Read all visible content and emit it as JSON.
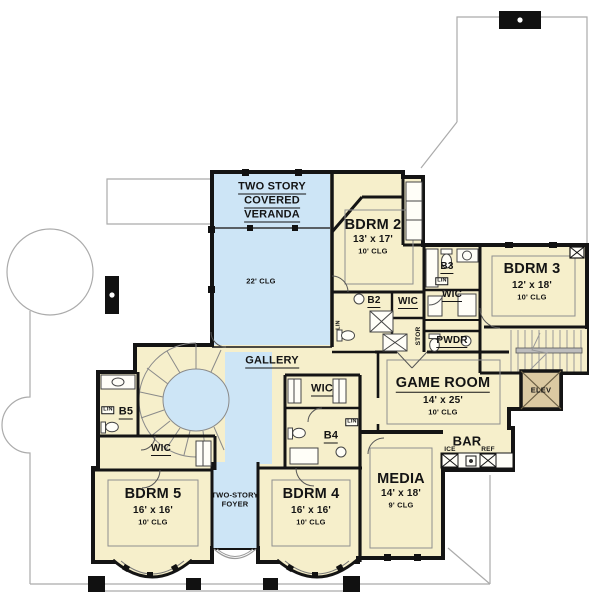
{
  "colors": {
    "room_fill": "#F6EFCB",
    "open_to_below_fill": "#CDE5F6",
    "elevator_fill": "#DBC9A2",
    "wall": "#141414",
    "roof_outline": "#ABABAB"
  },
  "icons": {
    "chimney_icon": "black box with white vent dot",
    "elevator_icon": "tan box with X cross",
    "stairs_icon": "parallel treads with rail",
    "spiral_stairs_icon": "radial fan treads around oval well",
    "door_icon": "quarter-circle swing arc",
    "window_icon": "black sill posts on wall",
    "shower_icon": "box with X",
    "toilet_icon": "ellipse bowl with tank",
    "sink_icon": "round basin"
  },
  "rooms": {
    "veranda": {
      "line1": "TWO STORY",
      "line2": "COVERED",
      "line3": "VERANDA",
      "clg": "22' CLG"
    },
    "bdrm2": {
      "name": "BDRM 2",
      "size": "13' x 17'",
      "clg": "10' CLG"
    },
    "bdrm3": {
      "name": "BDRM 3",
      "size": "12' x 18'",
      "clg": "10' CLG"
    },
    "game_room": {
      "name": "GAME ROOM",
      "size": "14' x 25'",
      "clg": "10' CLG"
    },
    "media": {
      "name": "MEDIA",
      "size": "14' x 18'",
      "clg": "9' CLG"
    },
    "bdrm4": {
      "name": "BDRM 4",
      "size": "16' x 16'",
      "clg": "10' CLG"
    },
    "bdrm5": {
      "name": "BDRM 5",
      "size": "16' x 16'",
      "clg": "10' CLG"
    },
    "foyer": {
      "line1": "TWO-STORY",
      "line2": "FOYER"
    },
    "gallery": {
      "name": "GALLERY"
    },
    "bar": {
      "name": "BAR",
      "ice": "ICE",
      "ref": "REF"
    },
    "elevator": {
      "name": "ELEV"
    },
    "b2": {
      "name": "B2"
    },
    "b3": {
      "name": "B3"
    },
    "b4": {
      "name": "B4"
    },
    "b5": {
      "name": "B5"
    },
    "pwdr": {
      "name": "PWDR"
    },
    "wic": {
      "name": "WIC"
    },
    "lin": {
      "name": "LIN"
    },
    "stor": {
      "name": "STOR"
    }
  }
}
